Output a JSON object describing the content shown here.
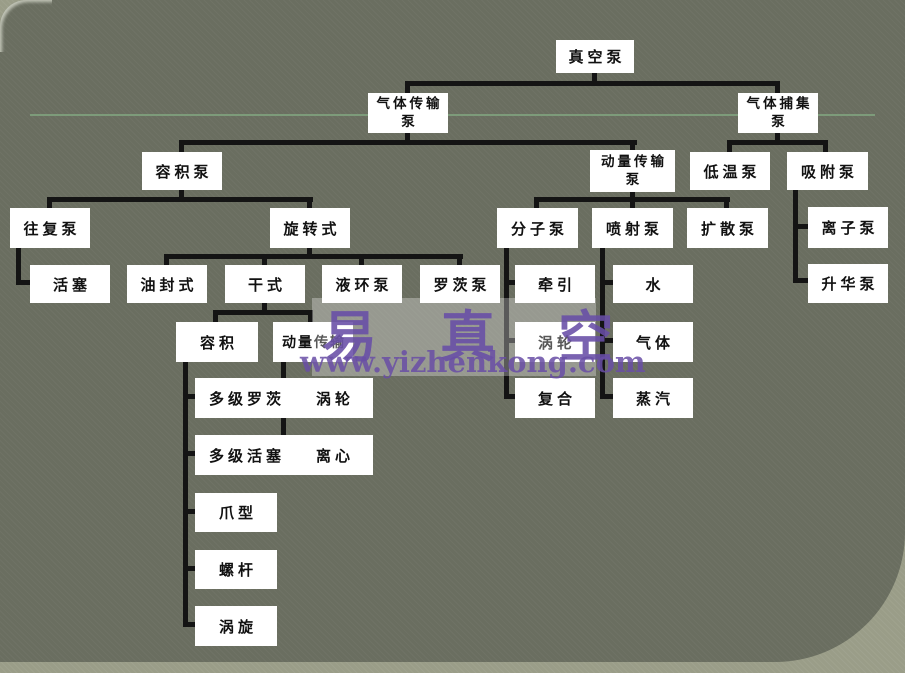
{
  "title": "真空泵分类图",
  "colors": {
    "slide_background": "#6a6e60",
    "outer_background": "#9a9d88",
    "box_fill": "#ffffff",
    "box_text": "#111111",
    "connector": "#141414",
    "divider_line": "#7d9b7a",
    "watermark_purple": "#684da6"
  },
  "watermark": {
    "brand": "易 真 空",
    "url": "www.yizhenkong.com"
  },
  "nodes": [
    {
      "id": "vacuum-pump",
      "label": "真空泵"
    },
    {
      "id": "gas-transfer-pump",
      "label": "气体传输泵",
      "line1": "气体传输",
      "line2": "泵"
    },
    {
      "id": "gas-capture-pump",
      "label": "气体捕集泵",
      "line1": "气体捕集",
      "line2": "泵"
    },
    {
      "id": "positive-displacement-pump",
      "label": "容积泵"
    },
    {
      "id": "momentum-transfer-pump",
      "label": "动量传输泵",
      "line1": "动量传输",
      "line2": "泵"
    },
    {
      "id": "cryo-pump",
      "label": "低温泵"
    },
    {
      "id": "adsorption-pump",
      "label": "吸附泵"
    },
    {
      "id": "reciprocating-pump",
      "label": "往复泵"
    },
    {
      "id": "rotary-type",
      "label": "旋转式"
    },
    {
      "id": "molecular-pump",
      "label": "分子泵"
    },
    {
      "id": "jet-pump",
      "label": "喷射泵"
    },
    {
      "id": "diffusion-pump",
      "label": "扩散泵"
    },
    {
      "id": "ion-pump",
      "label": "离子泵"
    },
    {
      "id": "piston",
      "label": "活塞"
    },
    {
      "id": "oil-sealed",
      "label": "油封式"
    },
    {
      "id": "dry-type",
      "label": "干式"
    },
    {
      "id": "liquid-ring-pump",
      "label": "液环泵"
    },
    {
      "id": "roots-pump",
      "label": "罗茨泵"
    },
    {
      "id": "drag",
      "label": "牵引"
    },
    {
      "id": "water",
      "label": "水"
    },
    {
      "id": "sublimation-pump",
      "label": "升华泵"
    },
    {
      "id": "volume",
      "label": "容积"
    },
    {
      "id": "momentum-transfer",
      "label": "动量传输"
    },
    {
      "id": "turbo",
      "label": "涡轮"
    },
    {
      "id": "gas",
      "label": "气体"
    },
    {
      "id": "multistage-roots",
      "label": "多级罗茨"
    },
    {
      "id": "turbine",
      "label": "涡轮"
    },
    {
      "id": "steam",
      "label": "蒸汽"
    },
    {
      "id": "compound",
      "label": "复合"
    },
    {
      "id": "multistage-piston",
      "label": "多级活塞"
    },
    {
      "id": "centrifugal",
      "label": "离心"
    },
    {
      "id": "claw",
      "label": "爪型"
    },
    {
      "id": "screw",
      "label": "螺杆"
    },
    {
      "id": "scroll",
      "label": "涡旋"
    }
  ],
  "tree": {
    "label": "真空泵",
    "children": [
      {
        "label": "气体传输泵",
        "children": [
          {
            "label": "容积泵",
            "children": [
              {
                "label": "往复泵",
                "children": [
                  {
                    "label": "活塞"
                  }
                ]
              },
              {
                "label": "旋转式",
                "children": [
                  {
                    "label": "油封式"
                  },
                  {
                    "label": "干式",
                    "children": [
                      {
                        "label": "容积",
                        "children": [
                          {
                            "label": "多级罗茨"
                          },
                          {
                            "label": "多级活塞"
                          },
                          {
                            "label": "爪型"
                          },
                          {
                            "label": "螺杆"
                          },
                          {
                            "label": "涡旋"
                          }
                        ]
                      },
                      {
                        "label": "动量传输",
                        "children": [
                          {
                            "label": "涡轮"
                          },
                          {
                            "label": "离心"
                          }
                        ]
                      }
                    ]
                  },
                  {
                    "label": "液环泵"
                  },
                  {
                    "label": "罗茨泵"
                  }
                ]
              }
            ]
          },
          {
            "label": "动量传输泵",
            "children": [
              {
                "label": "分子泵",
                "children": [
                  {
                    "label": "牵引"
                  },
                  {
                    "label": "涡轮"
                  },
                  {
                    "label": "复合"
                  }
                ]
              },
              {
                "label": "喷射泵",
                "children": [
                  {
                    "label": "水"
                  },
                  {
                    "label": "气体"
                  },
                  {
                    "label": "蒸汽"
                  }
                ]
              },
              {
                "label": "扩散泵"
              }
            ]
          }
        ]
      },
      {
        "label": "气体捕集泵",
        "children": [
          {
            "label": "低温泵"
          },
          {
            "label": "吸附泵",
            "children": [
              {
                "label": "离子泵"
              },
              {
                "label": "升华泵"
              }
            ]
          }
        ]
      }
    ]
  }
}
